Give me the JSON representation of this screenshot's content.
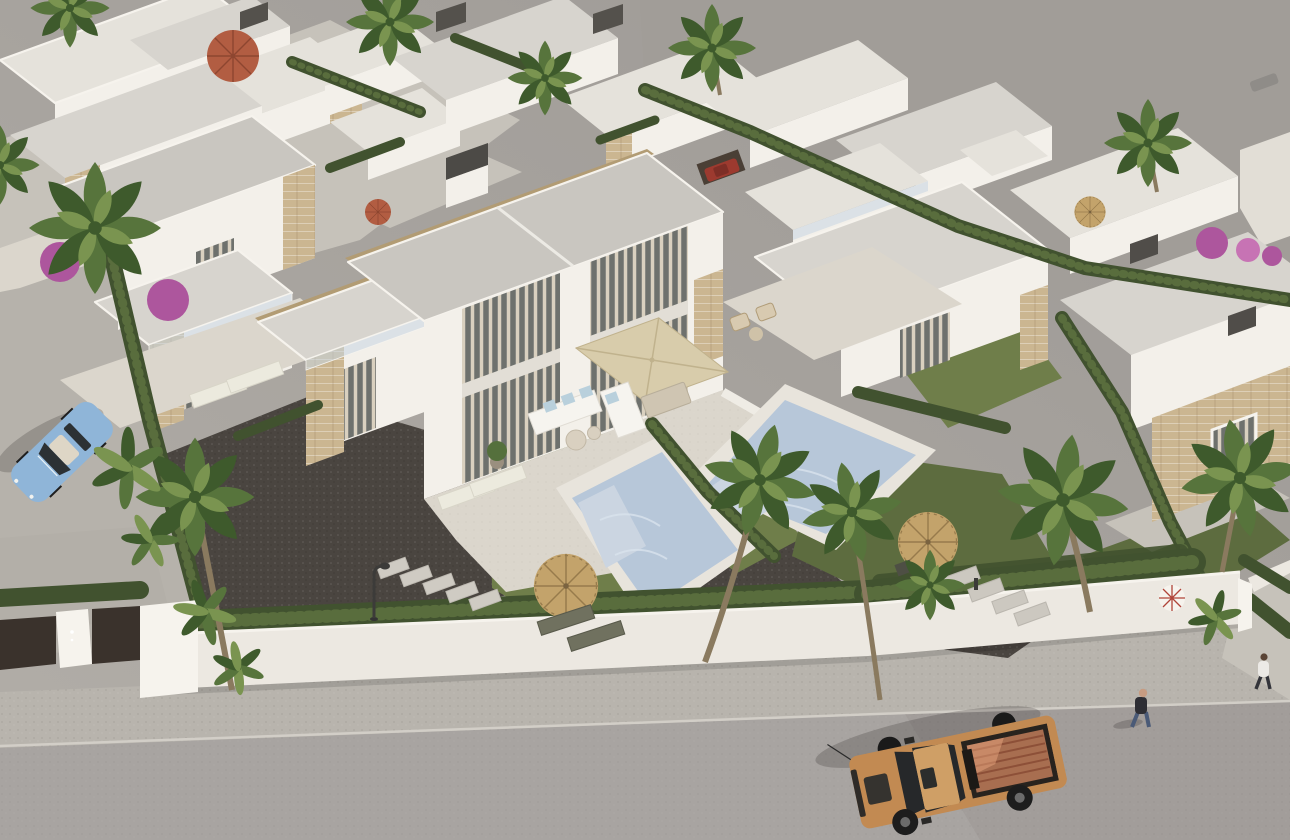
{
  "meta": {
    "description": "Aerial 3D architectural rendering of a modern residential development: white flat-roofed villas with sand-stone accent cladding, private pools, lawns, cypress hedges and palm trees; a perimeter white wall with a dark entrance gate along a grey street where an orange pickup truck is parked, a light-blue convertible sits on a side lane, and two pedestrians walk along the pavement; a large empty grey plot lies behind the back hedge.",
    "width": 1290,
    "height": 840
  },
  "palette": {
    "bg1": "#b2aea8",
    "bg2": "#9c9894",
    "vacant": "#a19d98",
    "road": "#a8a4a1",
    "curb": "#d2cec7",
    "sidewalk": "#b8b4ad",
    "leftroad": "#b6b2ab",
    "apron": "#c6c2ba",
    "padlight": "#b3afa8",
    "wall": "#ece8e1",
    "wallLight": "#f6f3ed",
    "roof": "#c9c6c0",
    "roofLight": "#d7d4ce",
    "roofPale": "#e5e2db",
    "white": "#f3f0ea",
    "whiteDim": "#e2ded6",
    "terrace": "#dbd6cc",
    "deck": "#e8e4dc",
    "stone": "#cbb691",
    "stoneDark": "#b29c74",
    "glass": "#6e716d",
    "curtain": "#d9d0bf",
    "glassRail": "rgba(198,214,226,0.55)",
    "hedge": "#41522f",
    "hedgeLight": "#5e7240",
    "grass": "#6f7e4a",
    "grassDark": "#5d6c3f",
    "gravel": "#4a4540",
    "pool": "#b7c7d9",
    "poolStep": "#cbd5e1",
    "palm": "#57743c",
    "palmDark": "#3e5a2c",
    "palmLight": "#7a9450",
    "trunk": "#8a7a5f",
    "thatch": "#c3a36b",
    "thatchRib": "#977b4c",
    "parasol": "#d8ccab",
    "parasolRib": "#c0b28d",
    "umbRed": "#b25d42",
    "umbRedRib": "#8d4630",
    "truck": "#c28a52",
    "truckBed": "#a86e50",
    "carBlue": "#8fb5d8",
    "carRed": "#9c3a2f",
    "carGray": "#8f8c88",
    "skin": "#c79c82",
    "boug": "#ad569d",
    "boug2": "#c773b4",
    "gate": "#3a322c",
    "metal": "#3c3b39",
    "shadow": "rgba(35,33,30,0.22)"
  },
  "scene": {
    "ground": [
      "vacant-grey-plot",
      "main-street",
      "pavement",
      "side-lane",
      "dark-gravel-driveway",
      "lawns",
      "stepping-stones"
    ],
    "buildings": [
      "central-two-storey-villa",
      "left-villa",
      "right-twin-villa",
      "far-right-villa",
      "back-row-villas",
      "top-left-villas",
      "perimeter-wall",
      "entrance-gate"
    ],
    "pools": [
      {
        "name": "central-villa-pool",
        "color": "#b7c7d9"
      },
      {
        "name": "neighbour-villa-pool",
        "color": "#b4c5d8"
      }
    ],
    "vegetation": [
      "fan-palms",
      "banana-plants",
      "cypress-hedges",
      "bougainvillea"
    ],
    "furniture": [
      "outdoor-corner-sofa",
      "beige-square-parasol",
      "dining-set",
      "straw-umbrellas",
      "sun-loungers",
      "red-patio-umbrellas",
      "potted-plant"
    ],
    "vehicles": [
      {
        "type": "pickup-truck",
        "color": "#c28a52",
        "location": "main-street"
      },
      {
        "type": "convertible",
        "color": "#8fb5d8",
        "location": "side-lane"
      },
      {
        "type": "parked-car",
        "color": "#9c3a2f",
        "location": "behind-hedge"
      }
    ],
    "people": [
      {
        "label": "pedestrian-dark-jacket-jeans",
        "location": "pavement"
      },
      {
        "label": "pedestrian-white-jacket",
        "location": "right-driveway"
      }
    ],
    "street_objects": [
      "street-lamp",
      "gate-pillar",
      "manhole-pad"
    ]
  }
}
